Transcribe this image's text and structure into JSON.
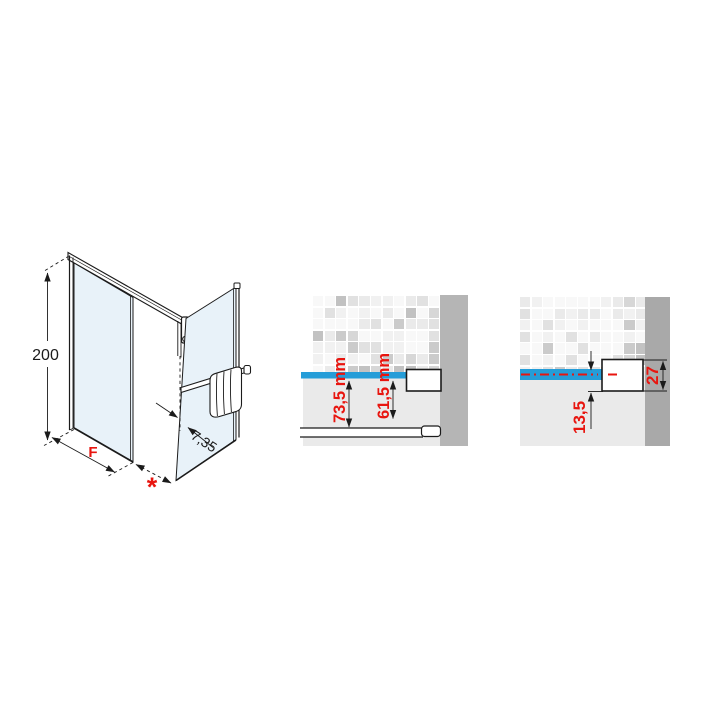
{
  "colors": {
    "red": "#e8150f",
    "blue": "#259dd8",
    "glass": "#e8f2f9",
    "wall_mid": "#b5b5b5",
    "wall_right": "#a9a9a9",
    "panel": "#eaeaea",
    "line": "#1b1b1b"
  },
  "iso_view": {
    "height_label": "200",
    "width_label": "F",
    "gap_label": "*",
    "depth_label": "7,35"
  },
  "detail_mid": {
    "dim_outer": "73,5 mm",
    "dim_inner": "61,5 mm"
  },
  "detail_right": {
    "dim_offset": "13,5",
    "dim_bracket": "27"
  }
}
